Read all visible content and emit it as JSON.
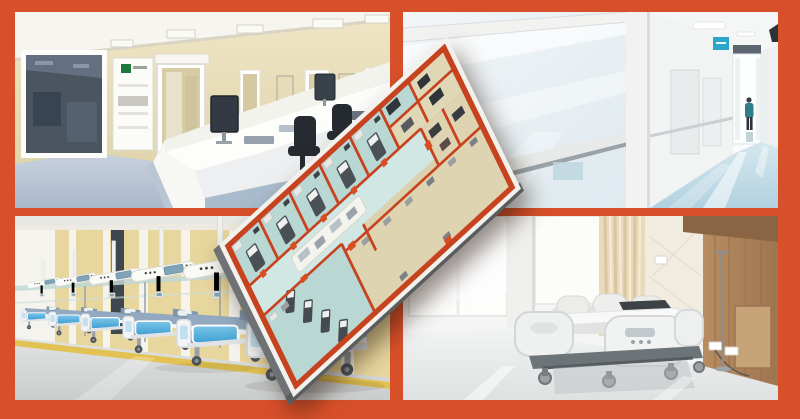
{
  "page": {
    "title": "ICU facility collage with 3D floor plan overlay"
  },
  "colors": {
    "frame": "#d8502a",
    "plan_wall": "#c7431f",
    "plan_door": "#d94d22",
    "plan_beige": "#dbd1ae",
    "plan_beige_light": "#e0d7b6",
    "plan_teal": "#b9d7d3",
    "plan_corridor": "#d0e7e3",
    "plan_slab_grey": "#6e7274",
    "ward_wall": "#e7d69d",
    "ward_floor": "#d8dada",
    "ward_yellow_line": "#e2c253",
    "bed_rail_blue": "#58b0dc",
    "mattress_blue_grey": "#93a9c0",
    "tl_wall": "#e2d5ac",
    "tl_floor": "#b6c2d4",
    "desk_base_blue": "#a9bccd",
    "corridor_glass": "#e9f0f4",
    "corridor_floor": "#c3dce8",
    "scrubs_teal": "#2e7f8a",
    "sign_blue": "#2ba6c9",
    "wood": "#ab7f56",
    "curtain": "#ead9ba",
    "room_floor": "#eceeee"
  },
  "panels": {
    "top_left": {
      "label": "3D render of ICU nurse station with curved desk, monitors and chairs"
    },
    "top_right": {
      "label": "Photo of bright hospital corridor with glass wall and clinician walking"
    },
    "bottom_left": {
      "label": "3D render of ICU ward with row of beds and ceiling supply pendants"
    },
    "bottom_right": {
      "label": "Photo of private patient room with hospital bed, sofa and wood wall"
    }
  },
  "overlay": {
    "label": "Tilted 3D ICU floor plan render with red walls"
  }
}
